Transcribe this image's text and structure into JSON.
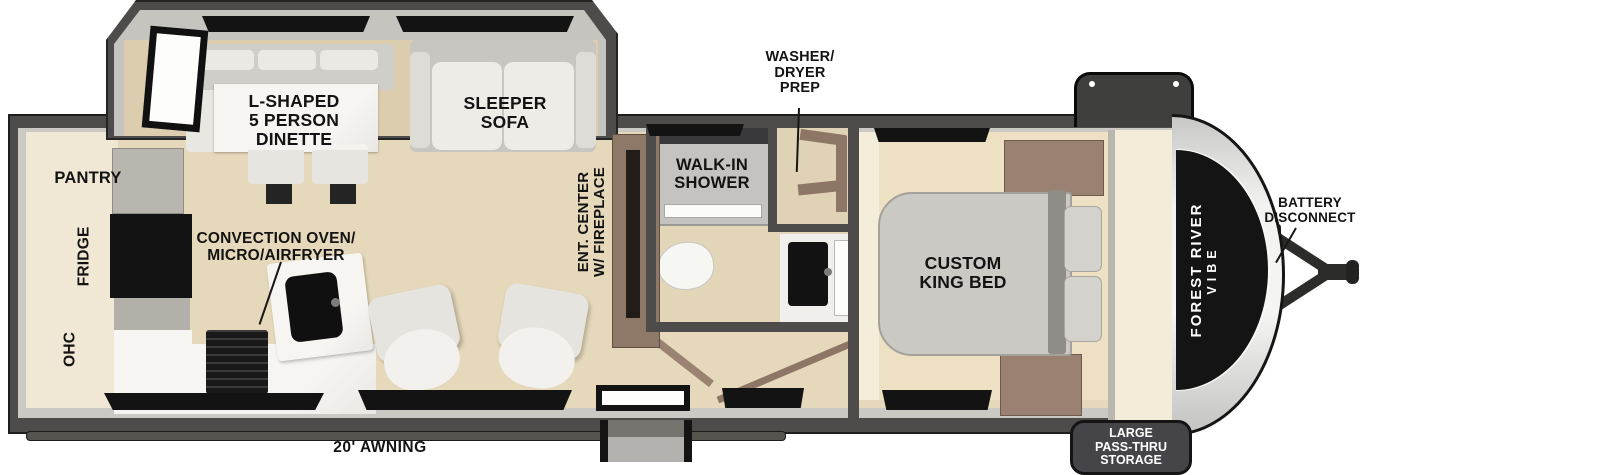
{
  "colors": {
    "wall": "#4d4c4a",
    "outline": "#1e1e1e",
    "floor": "#e6d8ba",
    "slide_floor": "#dbcdae",
    "kitchen_floor": "#f0e8d4",
    "label_text": "#131313",
    "appliance_black": "#131313",
    "cabinet_brown": "#8e7868",
    "counter_marble": "#f5f4f1",
    "bed_gray": "#cbc9c3",
    "wardrobe_cream": "#f3ecd8",
    "badge_text": "#ffffff"
  },
  "labels": {
    "dinette": "L-SHAPED\n5 PERSON\nDINETTE",
    "sleeper_sofa": "SLEEPER\nSOFA",
    "pantry": "PANTRY",
    "fridge": "FRIDGE",
    "ohc": "OHC",
    "convection": "CONVECTION OVEN/\nMICRO/AIRFRYER",
    "ent_center": "ENT. CENTER\nW/ FIREPLACE",
    "walk_in_shower": "WALK-IN\nSHOWER",
    "washer_dryer": "WASHER/\nDRYER\nPREP",
    "king_bed": "CUSTOM\nKING BED",
    "battery": "BATTERY\nDISCONNECT",
    "awning": "20' AWNING",
    "storage": "LARGE\nPASS-THRU\nSTORAGE"
  },
  "brand": {
    "name": "FOREST RIVER",
    "model": "VIBE"
  }
}
